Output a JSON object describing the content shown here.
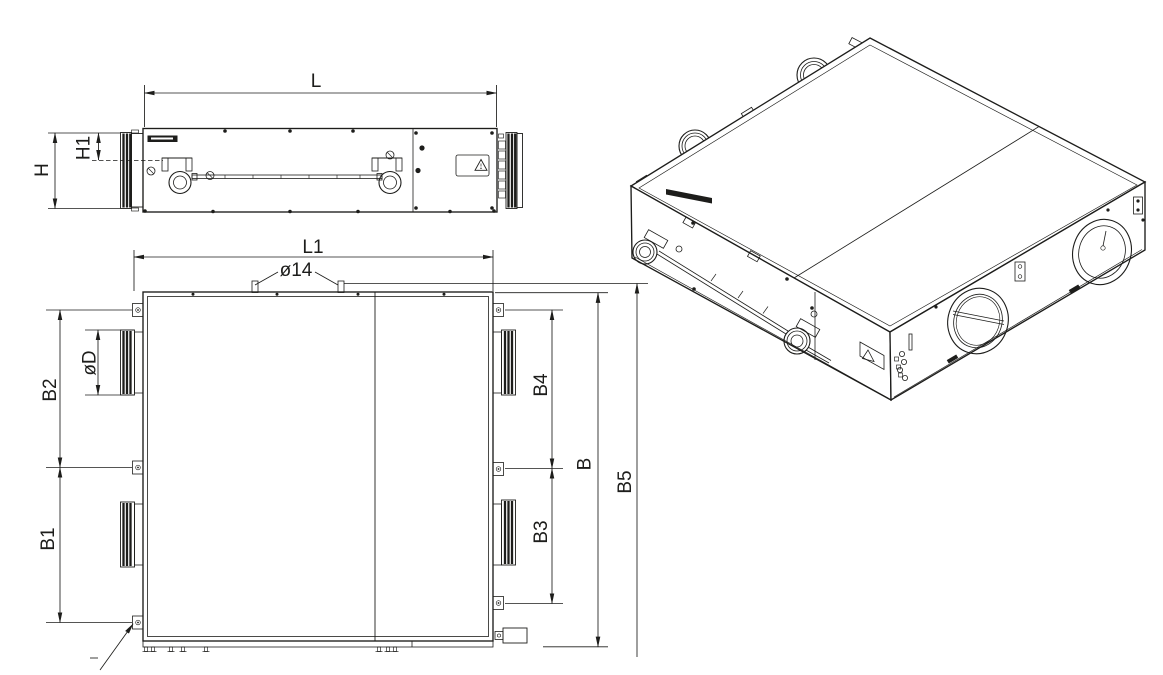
{
  "drawing": {
    "background": "#ffffff",
    "line_color": "#1d1d1b",
    "views": {
      "side": {
        "dims": {
          "L": "L",
          "H": "H",
          "H1": "H1"
        }
      },
      "plan": {
        "dims": {
          "L1": "L1",
          "hole_dia": "ø14",
          "duct_dia": "øD",
          "B2": "B2",
          "B1": "B1",
          "B4": "B4",
          "B3": "B3",
          "B": "B",
          "B5": "B5"
        }
      },
      "iso": {}
    },
    "icons": {
      "warning": "warning-triangle"
    }
  }
}
